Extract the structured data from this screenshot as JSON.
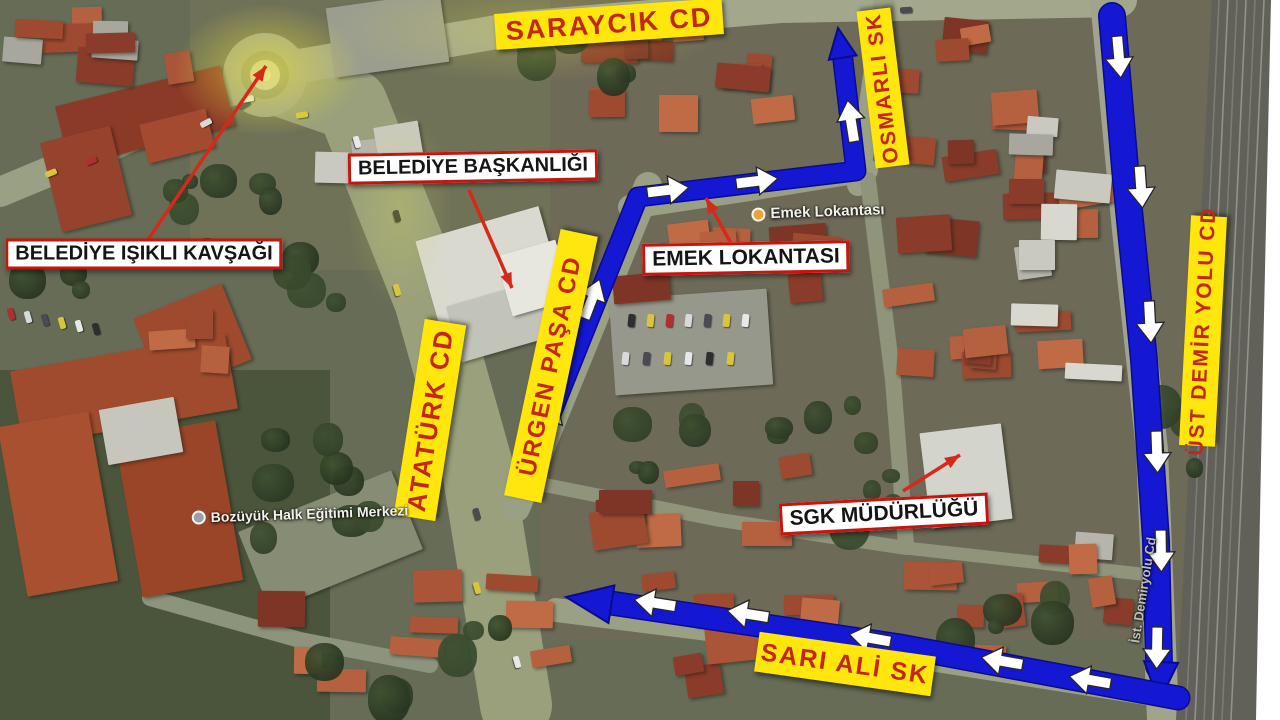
{
  "colors": {
    "route_blue": "#1518d2",
    "route_blue_edge": "#0a0a8f",
    "white_arrow_fill": "#ffffff",
    "white_arrow_edge": "#26262a",
    "label_yellow_bg": "#ffe60c",
    "label_red_text": "#c3261a",
    "box_border_red": "#c6150f",
    "red_arrow": "#d52a1a"
  },
  "road_labels": [
    {
      "name": "saraycik-cd",
      "text": "SARAYCIK CD",
      "cx": 609,
      "cy": 24,
      "len": 228,
      "h": 36,
      "rot": -4,
      "font": 27
    },
    {
      "name": "ataturk-cd",
      "text": "ATATÜRK CD",
      "cx": 430,
      "cy": 420,
      "len": 198,
      "h": 42,
      "rot": -81,
      "font": 26
    },
    {
      "name": "urgen-pasa-cd",
      "text": "ÜRGEN PAŞA CD",
      "cx": 551,
      "cy": 366,
      "len": 272,
      "h": 38,
      "rot": -78,
      "font": 24
    },
    {
      "name": "osmarli-sk",
      "text": "OSMARLI SK",
      "cx": 883,
      "cy": 88,
      "len": 158,
      "h": 34,
      "rot": -97,
      "font": 21
    },
    {
      "name": "ust-demir-yolu-cd",
      "text": "ÜST DEMİR YOLU CD",
      "cx": 1203,
      "cy": 331,
      "len": 230,
      "h": 36,
      "rot": -87,
      "font": 21
    },
    {
      "name": "sari-ali-sk",
      "text": "SARI ALİ SK",
      "cx": 845,
      "cy": 664,
      "len": 178,
      "h": 40,
      "rot": 8,
      "font": 25
    }
  ],
  "box_labels": [
    {
      "name": "belediye-isikli-kavsagi",
      "text": "BELEDİYE IŞIKLI KAVŞAĞI",
      "cx": 144,
      "cy": 254,
      "rot": 0,
      "font": 20
    },
    {
      "name": "belediye-baskanligi",
      "text": "BELEDİYE BAŞKANLIĞI",
      "cx": 473,
      "cy": 167,
      "rot": -1,
      "font": 20
    },
    {
      "name": "emek-lokantasi",
      "text": "EMEK LOKANTASI",
      "cx": 746,
      "cy": 258,
      "rot": -1,
      "font": 21
    },
    {
      "name": "sgk-mudurlugu",
      "text": "SGK MÜDÜRLÜĞÜ",
      "cx": 884,
      "cy": 514,
      "rot": -3,
      "font": 21
    }
  ],
  "ghost_labels": [
    {
      "name": "emek-lokantasi-place",
      "text": "Emek Lokantası",
      "cx": 818,
      "cy": 212,
      "rot": -2,
      "font": 15,
      "icon": "#e8a33d",
      "dim": false
    },
    {
      "name": "bozuyuk-halk-egitimi-merkezi",
      "text": "Bozüyük Halk Eğitimi Merkezi",
      "cx": 300,
      "cy": 514,
      "rot": -2,
      "font": 14,
      "icon": "#98a0a8",
      "dim": false
    },
    {
      "name": "ist-demiryolu-cd",
      "text": "İst. Demiryolu Cd",
      "cx": 1143,
      "cy": 590,
      "rot": -81,
      "font": 13,
      "icon": null,
      "dim": true
    }
  ],
  "red_arrows": [
    {
      "name": "red-arrow-to-kavsak",
      "x1": 143,
      "y1": 247,
      "x2": 266,
      "y2": 66
    },
    {
      "name": "red-arrow-to-baskanlik",
      "x1": 469,
      "y1": 190,
      "x2": 512,
      "y2": 288
    },
    {
      "name": "red-arrow-to-emek",
      "x1": 733,
      "y1": 247,
      "x2": 706,
      "y2": 198
    },
    {
      "name": "red-arrow-to-sgk",
      "x1": 903,
      "y1": 491,
      "x2": 960,
      "y2": 455
    }
  ],
  "routes": [
    {
      "name": "route-urgen-pasa-osmarli",
      "width": 18,
      "points": [
        [
          533,
          459
        ],
        [
          638,
          197
        ],
        [
          856,
          171
        ],
        [
          842,
          52
        ]
      ],
      "head": {
        "x": 838,
        "y": 28,
        "angle": -99,
        "len": 30,
        "half": 14
      }
    },
    {
      "name": "route-ust-demir-yolu",
      "width": 25,
      "points": [
        [
          1112,
          16
        ],
        [
          1126,
          180
        ],
        [
          1144,
          360
        ],
        [
          1156,
          540
        ],
        [
          1159,
          666
        ]
      ],
      "head": {
        "x": 1159,
        "y": 702,
        "angle": 93,
        "len": 40,
        "half": 17
      }
    },
    {
      "name": "route-sari-ali",
      "width": 22,
      "points": [
        [
          1178,
          698
        ],
        [
          900,
          646
        ],
        [
          604,
          602
        ]
      ],
      "head": {
        "x": 566,
        "y": 597,
        "angle": -171,
        "len": 46,
        "half": 19
      }
    }
  ],
  "white_arrows": [
    {
      "x": 549,
      "y": 421,
      "angle": -68
    },
    {
      "x": 592,
      "y": 299,
      "angle": -69
    },
    {
      "x": 668,
      "y": 190,
      "angle": -7
    },
    {
      "x": 757,
      "y": 181,
      "angle": -7
    },
    {
      "x": 851,
      "y": 121,
      "angle": -99
    },
    {
      "x": 1119,
      "y": 57,
      "angle": 85
    },
    {
      "x": 1141,
      "y": 187,
      "angle": 86
    },
    {
      "x": 1150,
      "y": 322,
      "angle": 87
    },
    {
      "x": 1157,
      "y": 452,
      "angle": 88
    },
    {
      "x": 1161,
      "y": 551,
      "angle": 89
    },
    {
      "x": 1157,
      "y": 648,
      "angle": 91
    },
    {
      "x": 655,
      "y": 603,
      "angle": -171
    },
    {
      "x": 748,
      "y": 614,
      "angle": -171
    },
    {
      "x": 870,
      "y": 638,
      "angle": -170
    },
    {
      "x": 1002,
      "y": 661,
      "angle": -170
    },
    {
      "x": 1090,
      "y": 680,
      "angle": -170
    }
  ]
}
